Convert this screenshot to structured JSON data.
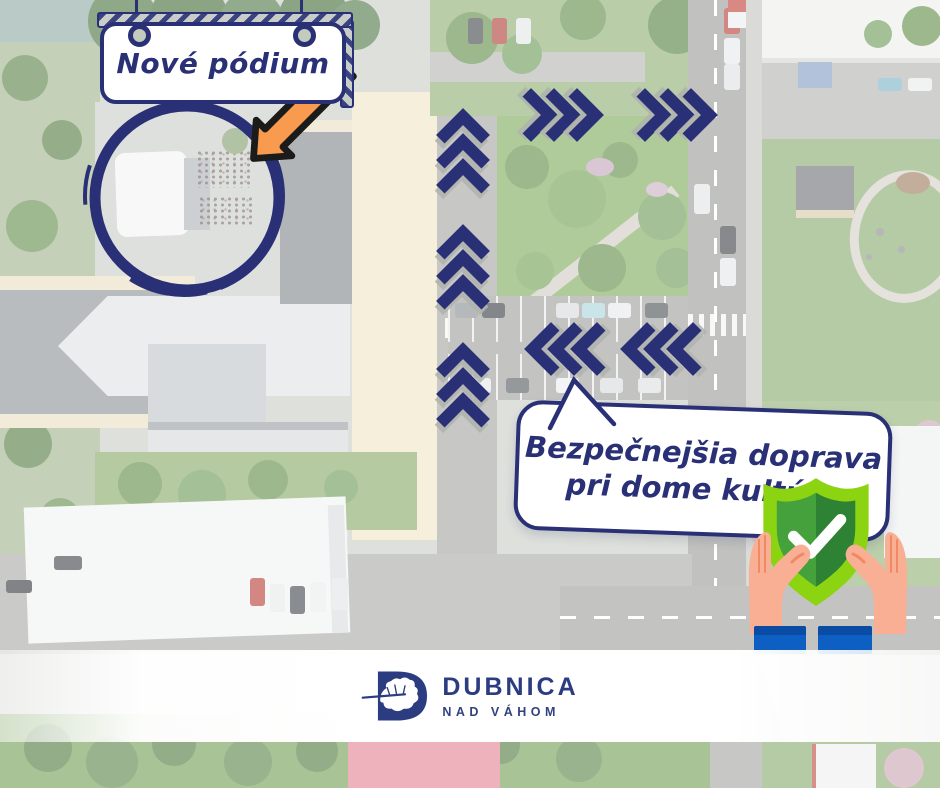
{
  "meta": {
    "kind": "municipal infographic",
    "language": "sk"
  },
  "colors": {
    "navy": "#293076",
    "orange": "#F89B4E",
    "orange_outline": "#1B1B1B",
    "shield_lime": "#8CD311",
    "shield_green": "#44A13C",
    "shield_green_dark": "#2E8233",
    "check_white": "#FFFFFF",
    "hand": "#F8AF94",
    "hand_line": "#EF8A64",
    "sleeve_blue": "#0D5FC4",
    "sleeve_blue_dark": "#0A4CA4",
    "banner_white": "#FFFFFF"
  },
  "callouts": {
    "sign": {
      "label": "Nové pódium"
    },
    "bubble": {
      "line1": "Bezpečnejšia doprava",
      "line2": "pri dome kultúry"
    }
  },
  "traffic_arrows": {
    "color": "#293076",
    "groups": [
      {
        "id": "up-1",
        "direction": "up",
        "chevrons": 3
      },
      {
        "id": "up-2",
        "direction": "up",
        "chevrons": 3
      },
      {
        "id": "up-3",
        "direction": "up",
        "chevrons": 3
      },
      {
        "id": "right-1",
        "direction": "right",
        "chevrons": 3
      },
      {
        "id": "right-2",
        "direction": "right",
        "chevrons": 3
      },
      {
        "id": "left-1",
        "direction": "left",
        "chevrons": 3
      },
      {
        "id": "left-2",
        "direction": "left",
        "chevrons": 3
      }
    ]
  },
  "icons": {
    "highlight_circle": "circle-highlight-icon",
    "arrow": "orange-arrow-icon",
    "shield": "shield-check-icon",
    "hands": "open-hands-icon",
    "logo_mark": "oak-leaf-d-logo-icon"
  },
  "footer": {
    "logo_title": "DUBNICA",
    "logo_subtitle": "NAD VÁHOM"
  }
}
